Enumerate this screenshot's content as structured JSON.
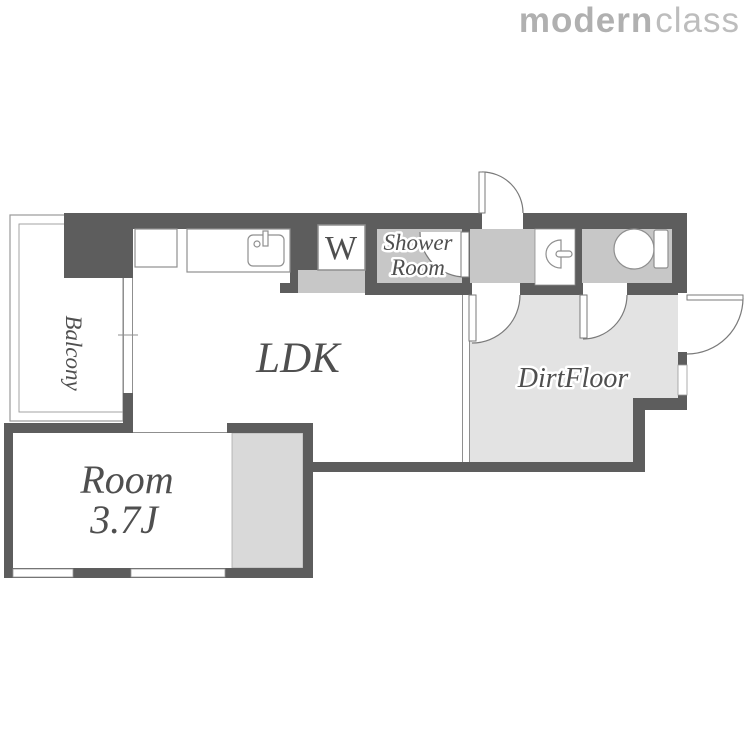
{
  "logo": {
    "bold": "modern",
    "light": "class"
  },
  "labels": {
    "balcony": "Balcony",
    "ldk": "LDK",
    "room_line1": "Room",
    "room_line2": "3.7J",
    "dirt_floor": "DirtFloor",
    "shower_line1": "Shower",
    "shower_line2": "Room",
    "washer": "W"
  },
  "colors": {
    "wall": "#5d5d5d",
    "room-gray": "#c7c7c7",
    "closet-gray": "#d9d9d9",
    "dirtfloor-gray": "#e3e3e3",
    "line": "#8f8f8f",
    "label": "#4f4f4f",
    "logo-bold": "#b0b0b0",
    "logo-light": "#bdbdbd"
  }
}
